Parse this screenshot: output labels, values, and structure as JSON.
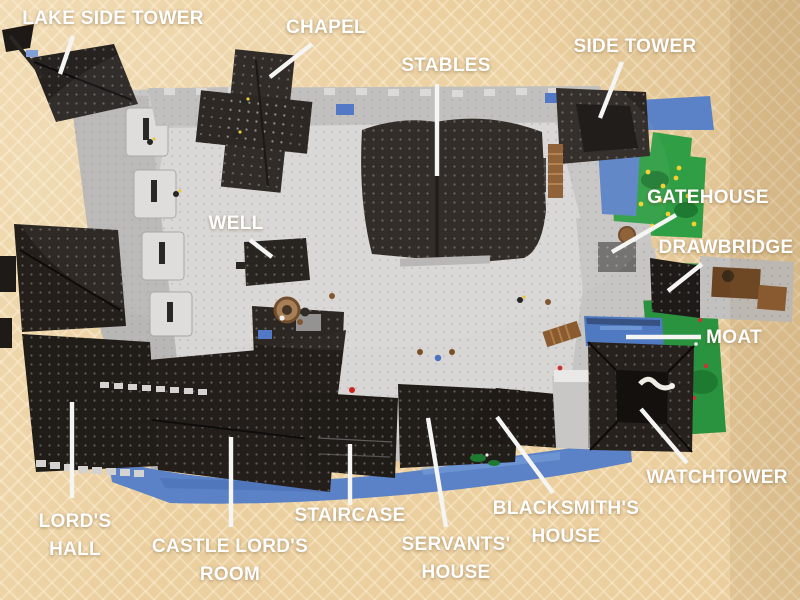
{
  "labels": [
    {
      "id": "lake-side-tower",
      "text": "LAKE SIDE TOWER"
    },
    {
      "id": "chapel",
      "text": "CHAPEL"
    },
    {
      "id": "stables",
      "text": "STABLES"
    },
    {
      "id": "side-tower",
      "text": "SIDE TOWER"
    },
    {
      "id": "gatehouse",
      "text": "GATEHOUSE"
    },
    {
      "id": "drawbridge",
      "text": "DRAWBRIDGE"
    },
    {
      "id": "moat",
      "text": "MOAT"
    },
    {
      "id": "well",
      "text": "WELL"
    },
    {
      "id": "watchtower",
      "text": "WATCHTOWER"
    },
    {
      "id": "lords-hall",
      "text": "LORD'S\nHALL"
    },
    {
      "id": "castle-lords-room",
      "text": "CASTLE LORD'S\nROOM"
    },
    {
      "id": "staircase",
      "text": "STAIRCASE"
    },
    {
      "id": "servants-house",
      "text": "SERVANTS'\nHOUSE"
    },
    {
      "id": "blacksmiths-house",
      "text": "BLACKSMITH'S\nHOUSE"
    }
  ],
  "colors": {
    "carpet_tan": "#ebcf9f",
    "label_text": "#ffffff",
    "leader_line": "#f5f5f3",
    "castle_gray": "#c6c5c3",
    "courtyard_gray": "#d7d6d4",
    "roof_black": "#221d19",
    "water_blue": "#5b82c6",
    "grass_green": "#2f9e44",
    "wood_brown": "#8a5a30"
  }
}
